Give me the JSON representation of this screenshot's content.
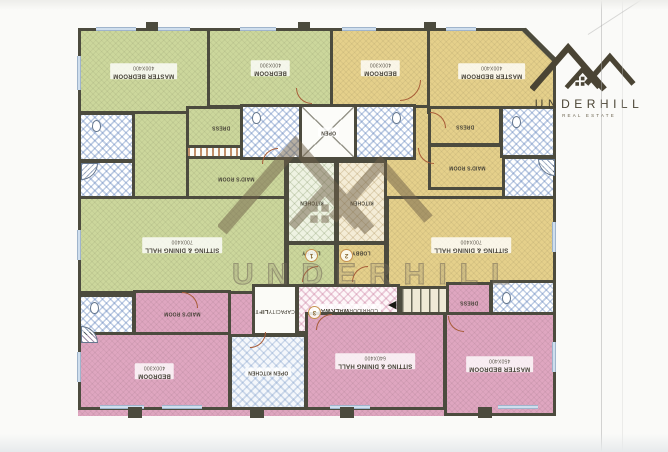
{
  "document": {
    "type": "apartment-floor-plan-scan"
  },
  "logo": {
    "name": "UNDERHILL",
    "tagline": "REAL ESTATE"
  },
  "watermark": {
    "text": "UNDERHILL"
  },
  "icons": {
    "stairs_arrow": "◀"
  },
  "colors": {
    "wall": "#4c4b3e",
    "unit_green": "#ccd79c",
    "unit_yellow": "#e5d08b",
    "unit_pink": "#dfa6c0",
    "bath_blue": "#9fb8d8",
    "door": "#a85c38",
    "logo": "#4a4434"
  },
  "rooms": {
    "master_a": {
      "label": "MASTER BEDROOM",
      "dims": "400X400"
    },
    "bedroom_a": {
      "label": "BEDROOM",
      "dims": "400X300"
    },
    "bedroom_b": {
      "label": "BEDROOM",
      "dims": "400X300"
    },
    "master_b": {
      "label": "MASTER BEDROOM",
      "dims": "400X400"
    },
    "dress_a": {
      "label": "DRESS"
    },
    "dress_b": {
      "label": "DRESS"
    },
    "dress_c": {
      "label": "DRESS"
    },
    "maid_a": {
      "label": "MAID'S ROOM"
    },
    "maid_b": {
      "label": "MAID'S ROOM"
    },
    "maid_c": {
      "label": "MAID'S ROOM"
    },
    "open_shaft": {
      "label": "OPEN"
    },
    "kitchen_1": {
      "label": "KITCHEN"
    },
    "kitchen_2": {
      "label": "KITCHEN"
    },
    "open_kitchen": {
      "label": "OPEN KITCHEN"
    },
    "sitting_a": {
      "label": "SITTING & DINING HALL",
      "dims": "700X400"
    },
    "sitting_b": {
      "label": "SITTING & DINING HALL",
      "dims": "700X400"
    },
    "sitting_c": {
      "label": "SITTING & DINING HALL",
      "dims": "640X400"
    },
    "bedroom_c": {
      "label": "BEDROOM",
      "dims": "400X300"
    },
    "master_c": {
      "label": "MASTER BEDROOM",
      "dims": "450X400"
    },
    "lift": {
      "label": "LIFT",
      "sublabel": "CAPACITY"
    },
    "walkway": {
      "label": "WALKWAY",
      "sublabel": "CORRIDOR"
    },
    "lobby_1": {
      "label": "LOBBY",
      "number": "1"
    },
    "lobby_2": {
      "label": "LOBBY",
      "number": "2"
    },
    "entrance_3": {
      "number": "3"
    }
  }
}
